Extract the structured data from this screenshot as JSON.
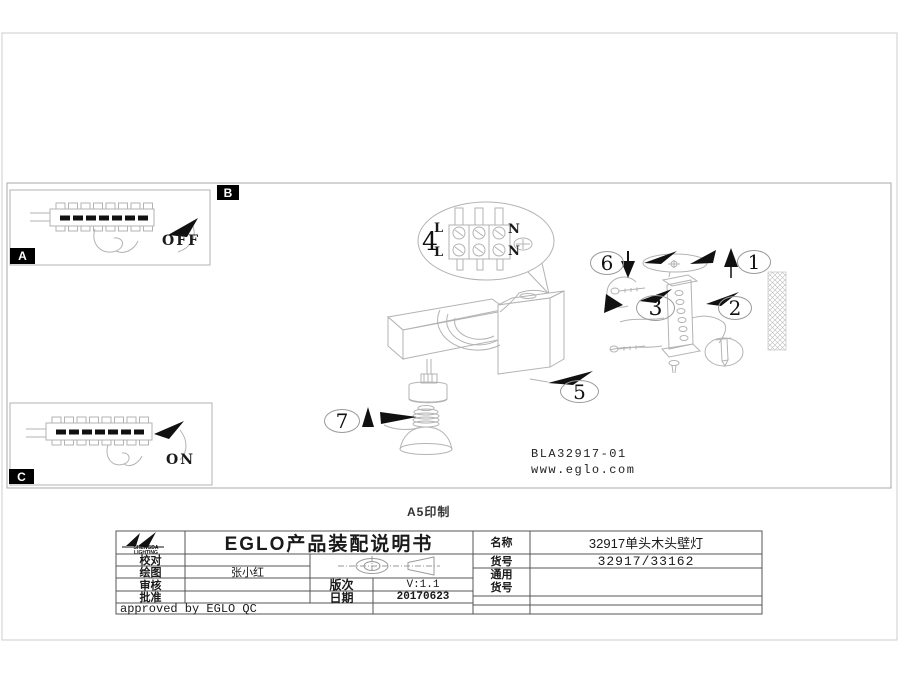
{
  "page": {
    "print_note": "A5印制"
  },
  "colors": {
    "ink": "#1a1a1a",
    "line_light": "#b3b3b3",
    "line_table": "#555555",
    "label_bg": "#000000"
  },
  "section_labels": {
    "a": "A",
    "b": "B",
    "c": "C"
  },
  "switches": {
    "off": "OFF",
    "on": "ON"
  },
  "wiring": {
    "part": "4",
    "l1": "L",
    "n1": "N",
    "l2": "L",
    "n2": "N"
  },
  "parts": {
    "p1": "1",
    "p2": "2",
    "p3": "3",
    "p5": "5",
    "p6": "6",
    "p7": "7"
  },
  "drawing_info": {
    "code": "BLA32917-01",
    "website": "www.eglo.com"
  },
  "title_block": {
    "logo_line1": "SHENGDA",
    "logo_line2": "LIGHTING",
    "title": "EGLO产品装配说明书",
    "proofread_label": "校对",
    "drawn_label": "绘图",
    "drawn_value": "张小红",
    "review_label": "审核",
    "approve_label": "批准",
    "version_label": "版次",
    "version_value": "V:1.1",
    "date_label": "日期",
    "date_value": "20170623",
    "approved_note": "approved by EGLO QC",
    "name_label": "名称",
    "name_value": "32917单头木头壁灯",
    "item_label": "货号",
    "item_value": "32917/33162",
    "common_label_line1": "通用",
    "common_label_line2": "货号"
  }
}
